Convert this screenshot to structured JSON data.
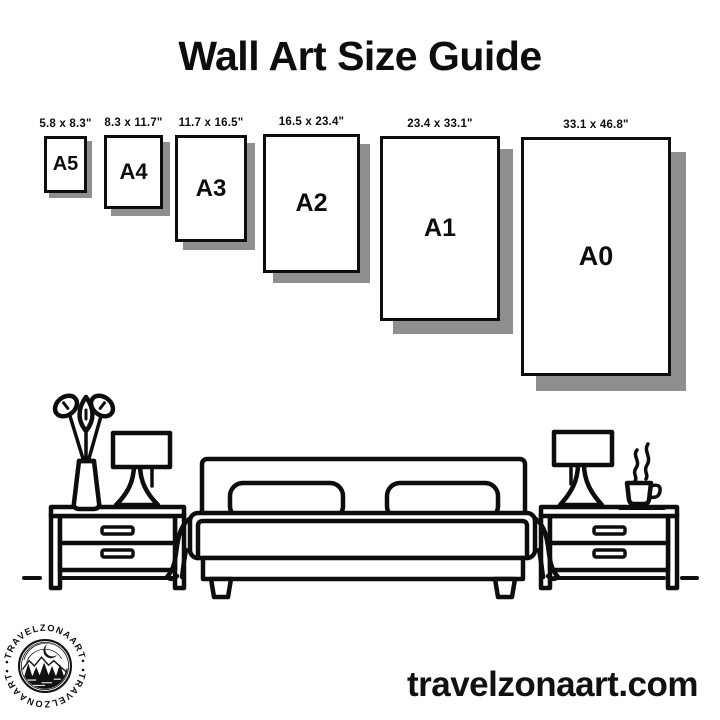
{
  "title": "Wall Art Size Guide",
  "website": "travelzonaart.com",
  "sizes": [
    {
      "code": "A5",
      "dimensions": "5.8 x 8.3\""
    },
    {
      "code": "A4",
      "dimensions": "8.3 x 11.7\""
    },
    {
      "code": "A3",
      "dimensions": "11.7 x 16.5\""
    },
    {
      "code": "A2",
      "dimensions": "16.5 x 23.4\""
    },
    {
      "code": "A1",
      "dimensions": "23.4 x 33.1\""
    },
    {
      "code": "A0",
      "dimensions": "33.1 x 46.8\""
    }
  ],
  "logo": {
    "arc_text_top": "•TRAVELZONAART•",
    "arc_text_bottom": "•TRAVELZONAART•"
  },
  "scene_items": [
    "flower-vase",
    "table-lamp-left",
    "nightstand-left",
    "bed",
    "nightstand-right",
    "table-lamp-right",
    "coffee-cup"
  ],
  "colors": {
    "ink": "#0d0d0d",
    "shadow": "#8f8f8f",
    "background": "#ffffff"
  }
}
